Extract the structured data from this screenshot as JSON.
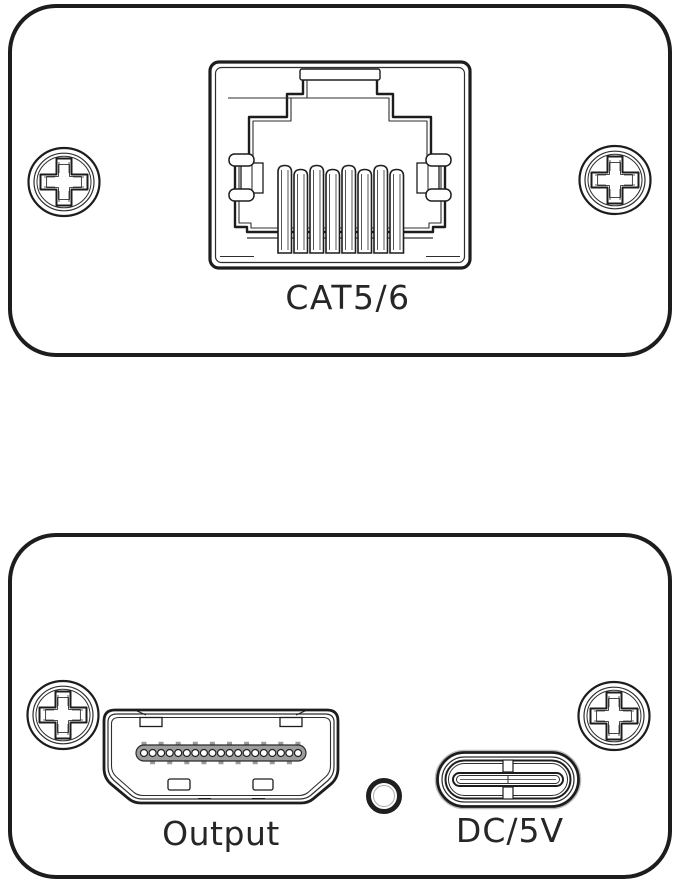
{
  "diagram": {
    "description": "Two wall-plate faceplate panels shown front-on as line art",
    "colors": {
      "line": "#1d1d1d",
      "text": "#262626",
      "background": "#ffffff"
    },
    "panels": {
      "top": {
        "port_label": "CAT5/6",
        "port_icon": "rj45-jack",
        "screw_count": 2
      },
      "bottom": {
        "output_label": "Output",
        "power_label": "DC/5V",
        "port_icons": [
          "hdmi-type-a",
          "led-hole",
          "usb-c"
        ],
        "screw_count": 2
      }
    }
  }
}
